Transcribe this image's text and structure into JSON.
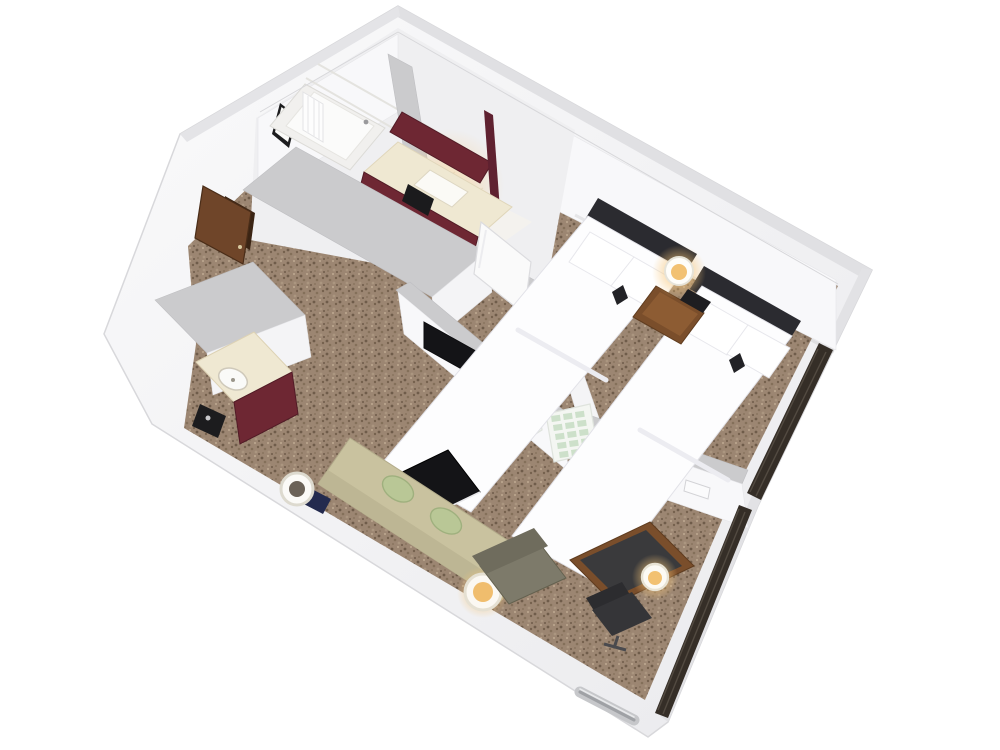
{
  "scene": {
    "description": "3D isometric cutaway floor-plan render of a hotel guest suite with two double beds, bathroom with tub, vanity area, wet bar, and a living area with sofa, desk and wall TV",
    "background_color": "#ffffff"
  },
  "palette": {
    "wall_white": "#f5f5f7",
    "wall_top_gray": "#cbcbcd",
    "exterior_rim_gray": "#e0e0e3",
    "carpet_base": "#9c8672",
    "carpet_speckle_dark": "#6f5c4a",
    "carpet_speckle_light": "#b9a48d",
    "tile_white": "#f4f2ee",
    "vanity_maroon": "#6e2733",
    "counter_cream": "#efe8d2",
    "wood_brown": "#7a4e2b",
    "wood_light": "#8d5c33",
    "headboard_charcoal": "#2b2b30",
    "bedding_white": "#fdfdfe",
    "sofa_beige": "#c9c29f",
    "pillow_green": "#b9c796",
    "table_black": "#141417",
    "armchair_olive": "#7d7a6a",
    "chair_dark": "#353538",
    "curtain_dark": "#352e27",
    "louver_green": "#cde0ca",
    "door_brown": "#6f4529",
    "artwork_orange": "#d4502a",
    "lamp_glow": "#f2c172",
    "navy_accent": "#232a4e",
    "metal_silver": "#c6c7ca"
  },
  "rooms": [
    {
      "id": "bathroom",
      "label": "bathroom with tub"
    },
    {
      "id": "vanity-area",
      "label": "vanity / sink area"
    },
    {
      "id": "entry",
      "label": "entry with door"
    },
    {
      "id": "closet",
      "label": "closet with louver doors"
    },
    {
      "id": "wet-bar",
      "label": "wet bar"
    },
    {
      "id": "bedroom",
      "label": "bedroom with two double beds"
    },
    {
      "id": "living-area",
      "label": "living area"
    }
  ],
  "furniture": [
    {
      "id": "bathtub",
      "label": "bathtub with shower curtain"
    },
    {
      "id": "framed-artwork",
      "label": "framed abstract artwork"
    },
    {
      "id": "vanity-mirror",
      "label": "maroon framed mirror"
    },
    {
      "id": "vanity-sink",
      "label": "vanity counter with sink"
    },
    {
      "id": "trash-bin",
      "label": "waste bin"
    },
    {
      "id": "entry-door",
      "label": "open entry door"
    },
    {
      "id": "wet-bar-counter",
      "label": "wet bar counter with sink and coffee maker"
    },
    {
      "id": "bed-1",
      "label": "double bed"
    },
    {
      "id": "bed-2",
      "label": "double bed"
    },
    {
      "id": "nightstand",
      "label": "nightstand with lamp and telephone"
    },
    {
      "id": "wall-tv",
      "label": "wall-mounted TV"
    },
    {
      "id": "louver-doors",
      "label": "open louvered closet doors"
    },
    {
      "id": "bedroom-door",
      "label": "open interior door"
    },
    {
      "id": "sofa",
      "label": "sofa with green pillows and end lamps"
    },
    {
      "id": "coffee-table",
      "label": "black coffee table"
    },
    {
      "id": "armchair",
      "label": "olive armchair"
    },
    {
      "id": "desk",
      "label": "wooden desk with lamp"
    },
    {
      "id": "desk-chair",
      "label": "office chair"
    },
    {
      "id": "thermostat",
      "label": "wall thermostat"
    },
    {
      "id": "curtains",
      "label": "dark window curtains"
    },
    {
      "id": "vent-handle",
      "label": "exterior vent / rail"
    }
  ]
}
